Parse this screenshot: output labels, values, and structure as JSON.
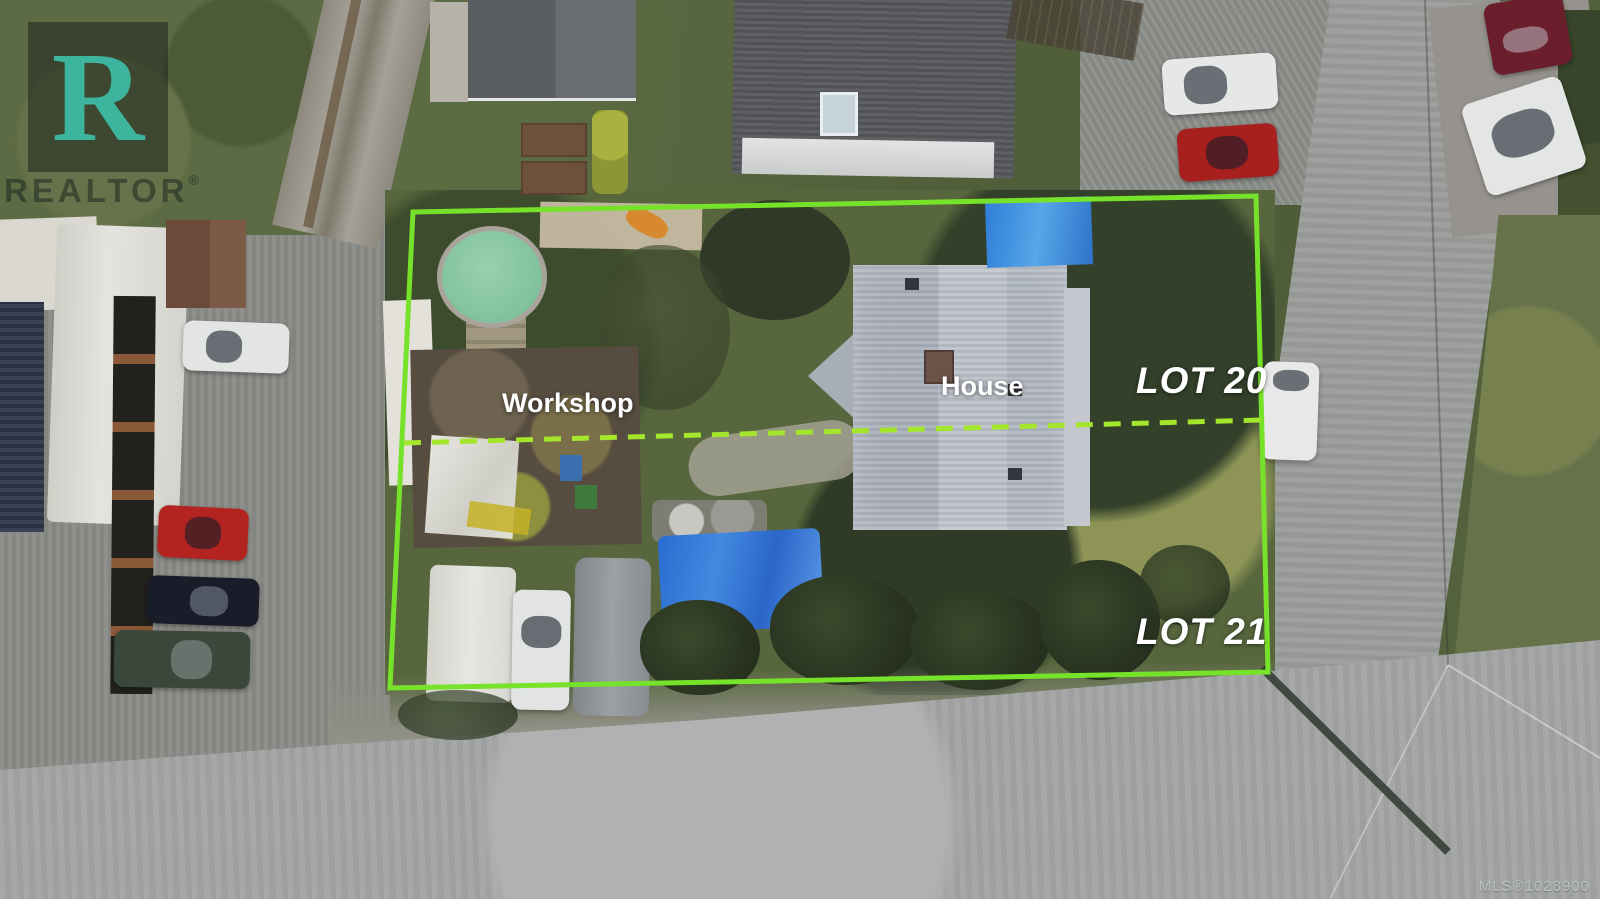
{
  "watermark": {
    "letter": "R",
    "brand": "REALTOR",
    "registered_symbol": "®"
  },
  "labels": {
    "house": "House",
    "workshop": "Workshop",
    "lot_top": "LOT 20",
    "lot_bottom": "LOT 21"
  },
  "footer": {
    "mls_number": "MLS®1028900"
  },
  "colors": {
    "boundary_green": "#77e22a",
    "divider_green": "#a3e62c",
    "label_white": "#ffffff",
    "tarp_blue": "#2f7ed8",
    "pool_green": "#85c7a2",
    "watermark_teal": "#3ec4ac"
  }
}
